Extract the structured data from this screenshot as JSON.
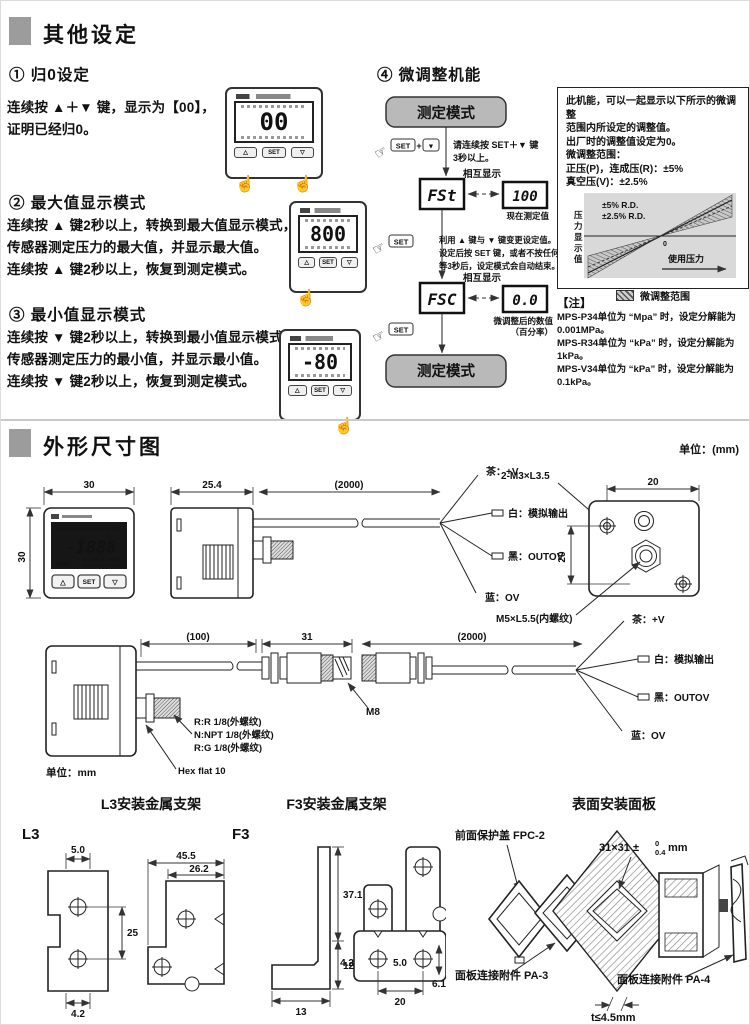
{
  "keys": {
    "up": "△",
    "set": "SET",
    "down": "▽"
  },
  "other": {
    "title": "其他设定",
    "zero": {
      "heading": "① 归0设定",
      "line1": "连续按 ▲＋▼ 键，显示为【00】，",
      "line2": "证明已经归0。",
      "value": "00"
    },
    "max": {
      "heading": "② 最大值显示模式",
      "line1": "连续按 ▲ 键2秒以上，转换到最大值显示模式，",
      "line2": "传感器测定压力的最大值，并显示最大值。",
      "line3": "连续按 ▲ 键2秒以上，恢复到测定模式。",
      "value": "800"
    },
    "min": {
      "heading": "③ 最小值显示模式",
      "line1": "连续按 ▼ 键2秒以上，转换到最小值显示模式，",
      "line2": "传感器测定压力的最小值，并显示最小值。",
      "line3": "连续按 ▼ 键2秒以上，恢复到测定模式。",
      "value": "-80"
    },
    "adjust": {
      "heading": "④ 微调整机能",
      "mode_top": "测定模式",
      "mode_bottom": "测定模式",
      "key_set": "SET",
      "key_down": "▼",
      "plus": "+",
      "step1a": "请连续按 SET＋▼ 键",
      "step1b": "3秒以上。",
      "disp1": "FSt",
      "mutual": "相互显示",
      "val1": "100",
      "cap1": "现在测定值",
      "step2a": "利用 ▲ 键与 ▼ 键变更设定值。",
      "step2b": "设定后按 SET 键，或者不按任何键",
      "step2c": "等3秒后，设定模式会自动结束。",
      "disp2": "FSC",
      "val2": "0.0",
      "cap2a": "微调整后的数值",
      "cap2b": "（百分率）",
      "info": {
        "l1": "此机能，可以一起显示以下所示的微调整",
        "l2": "范围内所设定的调整值。",
        "l3": "出厂时的调整值设定为0。",
        "l4": "微调整范围：",
        "l5": "正压(P)，连成压(R)：±5%",
        "l6": "真空压(V)：±2.5%"
      },
      "graph": {
        "band5": "±5% R.D.",
        "band25": "±2.5% R.D.",
        "ylabel": "压力显示值",
        "xlabel": "使用压力",
        "zero": "0",
        "legend": "微调整范围"
      },
      "note": {
        "title": "【注】",
        "l1": "MPS-P34单位为 “Mpa” 时，设定分解能为0.001MPa。",
        "l2": "MPS-R34单位为 “kPa” 时，设定分解能为1kPa。",
        "l3": "MPS-V34单位为 “kPa” 时，设定分解能为0.1kPa。"
      }
    }
  },
  "dim": {
    "title": "外形尺寸图",
    "unit": "单位：(mm)",
    "unit2": "单位：mm",
    "front": {
      "w": "30",
      "h": "30",
      "units": "mmHg inHg PSI BAR kgf kPa",
      "digits": "-1888",
      "out": "OUT",
      "flags1": "MAX  MIN  N.C AUTO",
      "flags2": "MIN  HYS  N.O BAR"
    },
    "side": {
      "body": "25.4",
      "cable": "(2000)"
    },
    "rear": {
      "screw": "2-M3×L3.5",
      "w": "20",
      "h": "20",
      "port": "M5×L5.5(内螺纹)"
    },
    "conn": {
      "cable1": "(100)",
      "conn": "31",
      "cable2": "(2000)",
      "m8": "M8",
      "t1": "R:R 1/8(外螺纹)",
      "t2": "N:NPT 1/8(外螺纹)",
      "t3": "R:G 1/8(外螺纹)",
      "hex": "Hex flat 10"
    },
    "wires": {
      "brown": "茶：+V",
      "white": "白：模拟输出",
      "black": "黑：OUTOV",
      "blue": "蓝：OV"
    },
    "l3": {
      "title": "L3安装金属支架",
      "label": "L3",
      "d1": "5.0",
      "d2": "25",
      "d3": "4.2",
      "d4": "45.5",
      "d5": "26.2"
    },
    "f3": {
      "title": "F3安装金属支架",
      "label": "F3",
      "d1": "37.1",
      "d2": "12.9",
      "d3": "13",
      "d4": "4.2",
      "d5": "5.0",
      "d6": "20",
      "d7": "6.1"
    },
    "panel": {
      "title": "表面安装面板",
      "cover": "前面保护盖 FPC-2",
      "cut": "31×31 ±",
      "cut_sup": "0",
      "cut_sub": "0.4",
      "cut_unit": "mm",
      "pa3": "面板连接附件 PA-3",
      "pa4": "面板连接附件 PA-4",
      "thick": "t≤4.5mm"
    }
  }
}
